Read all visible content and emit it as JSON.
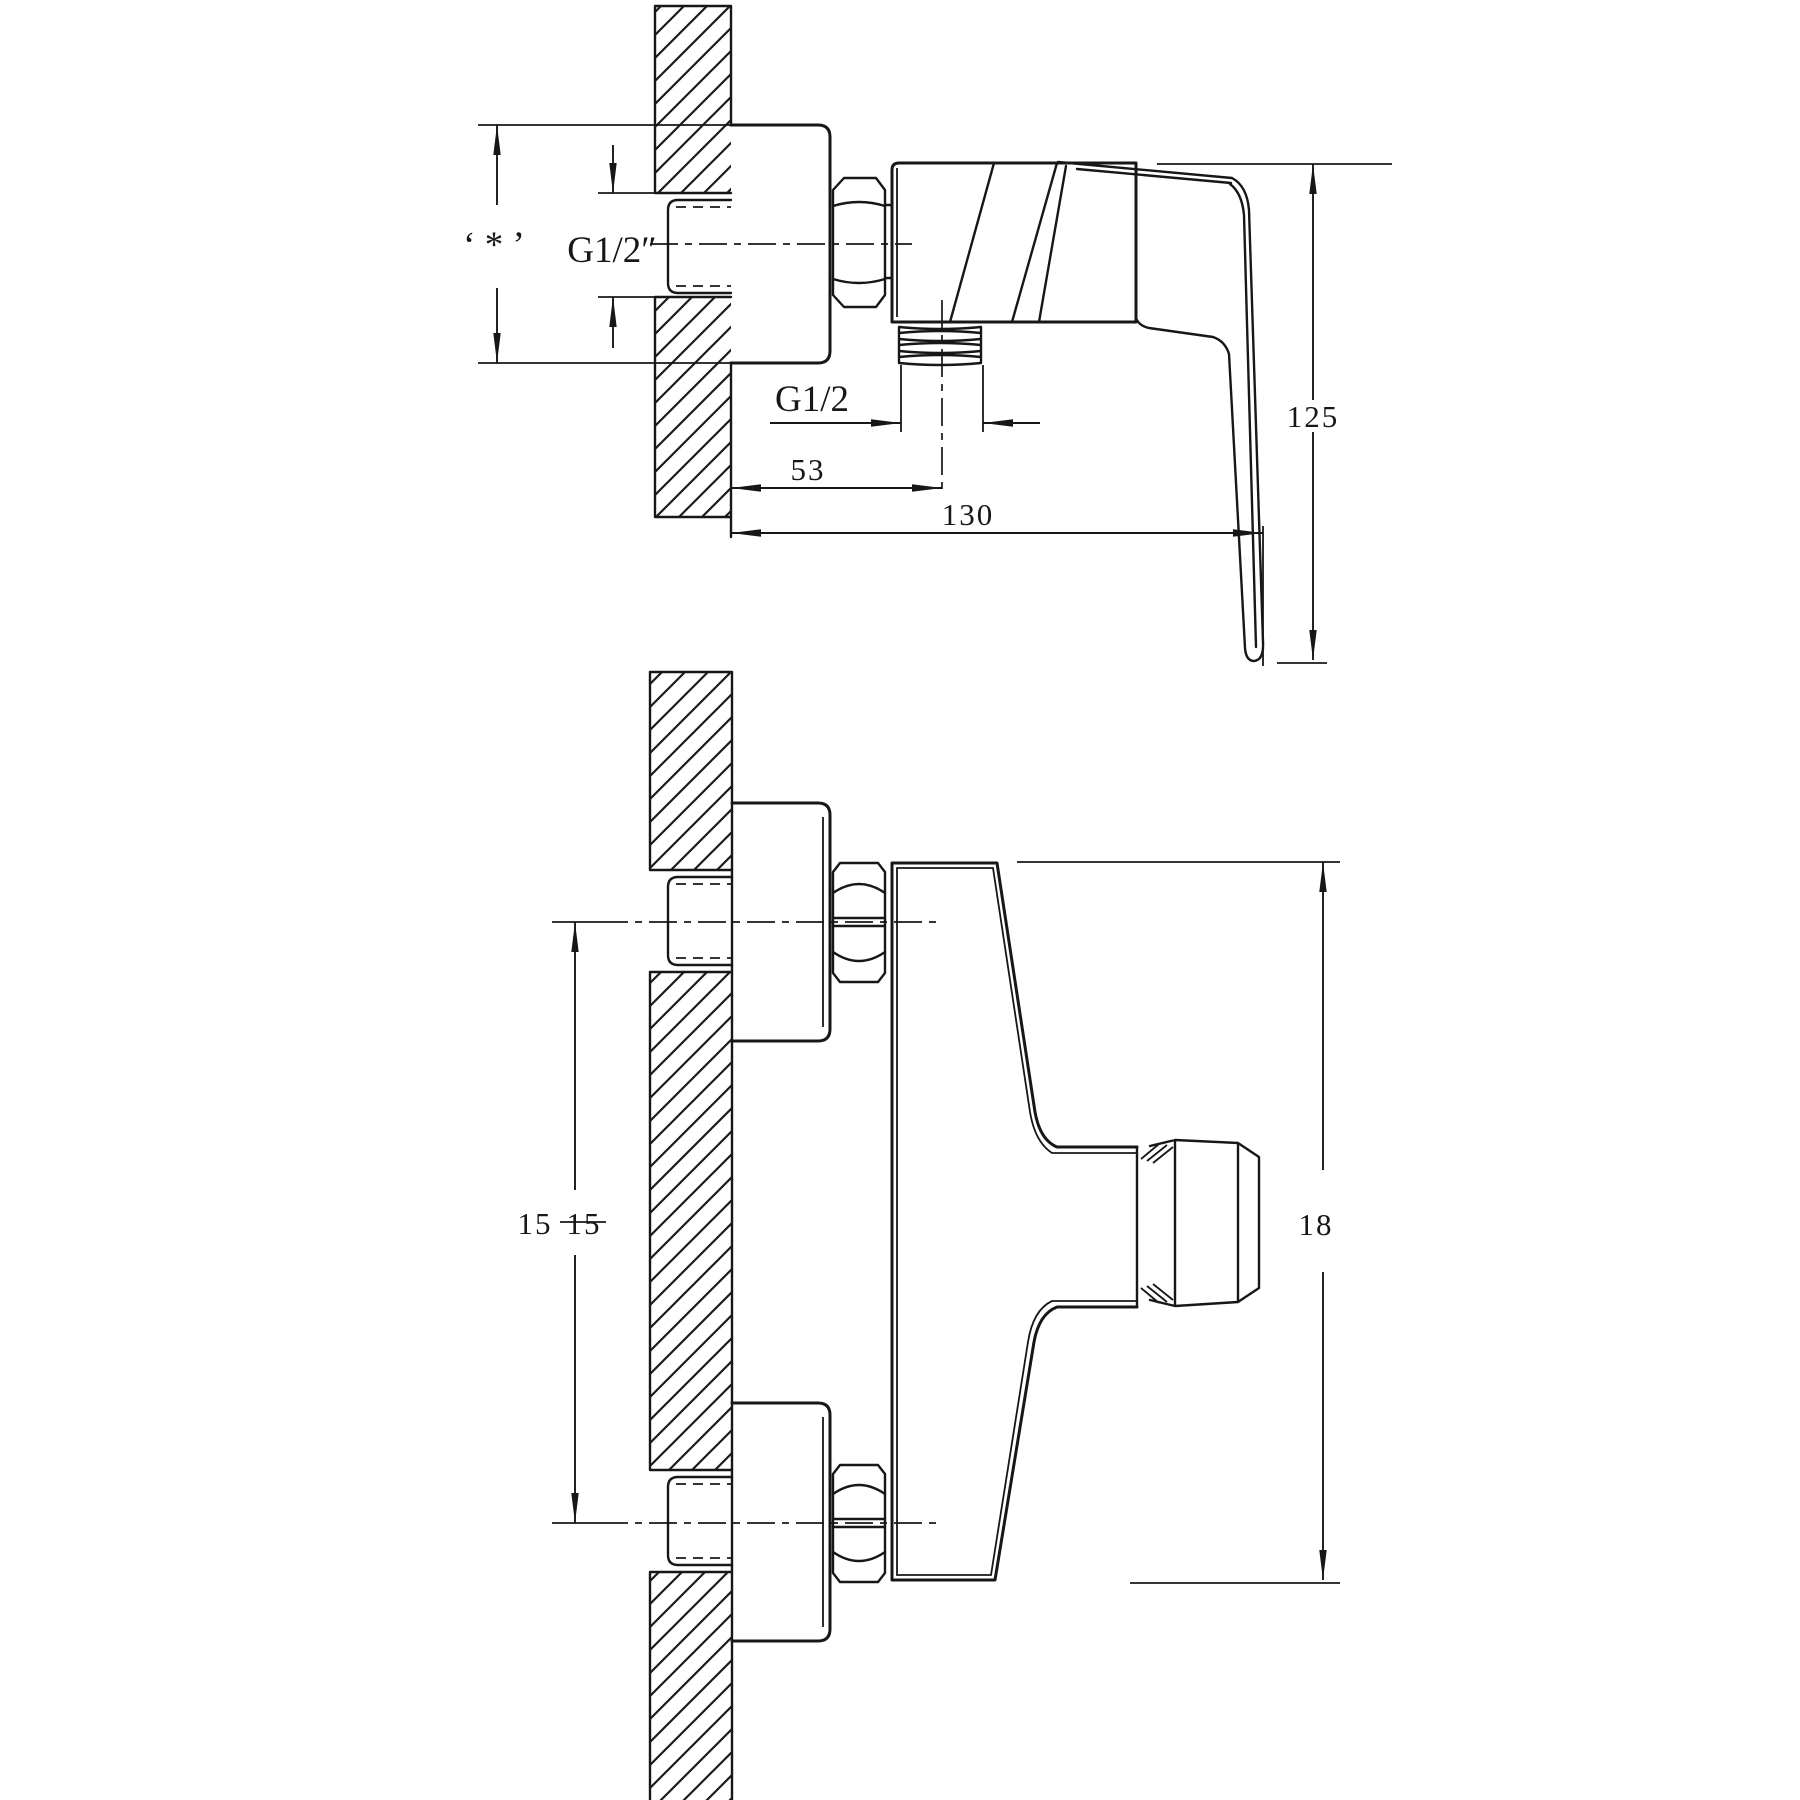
{
  "drawing": {
    "kind": "technical line drawing, wall-mounted single-lever shower mixer, two orthographic views",
    "background_color": "#ffffff",
    "line_color": "#17171a"
  },
  "views": {
    "side_view": {
      "name": "side section view (upper)",
      "labels": {
        "plate_height_ref": "‘ * ’",
        "inlet_thread": "G1/2″",
        "outlet_thread": "G1/2",
        "outlet_offset_mm": "53",
        "total_depth_mm": "130",
        "handle_drop_mm": "125"
      }
    },
    "front_view": {
      "name": "front view (lower)",
      "labels": {
        "inlet_spacing_left_mm": "15",
        "inlet_spacing_right_mm": "15",
        "body_height_mm": "18"
      }
    }
  }
}
